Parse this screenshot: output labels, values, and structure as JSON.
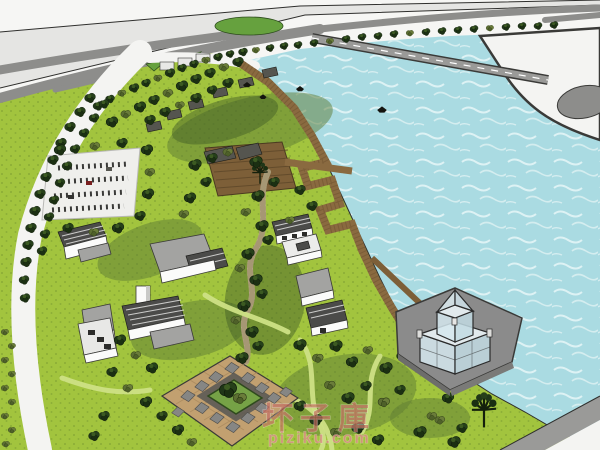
{
  "watermark": {
    "brand": "坏子庫",
    "domain": "piziku.com"
  },
  "palette": {
    "water": "#aadbe2",
    "water_wave": "#e9f7f8",
    "ground_white": "#f6f6f4",
    "highway_light": "#e5e5e3",
    "road_gray": "#8d8d8b",
    "lawn": "#a2c43e",
    "tree_dark": "#203618",
    "tree_olive": "#5c6e33",
    "boardwalk": "#8a6a40",
    "deck_wood": "#7d5f38",
    "building_wall": "#fbfbfa",
    "building_roof": "#a3a3a1",
    "roof_dark": "#4b4b49",
    "plaza_tan": "#c2a070",
    "plaza_gray": "#868684",
    "platform_gray": "#8b8b8b",
    "glass": "#d5e8ee",
    "watermark_red": "#b5483c",
    "watermark_pink": "#d98d86"
  },
  "scene": {
    "type": "3d-sketchup-aerial-site-plan",
    "elements": [
      "lake",
      "shoreline-boardwalk",
      "zigzag-pier",
      "wooden-deck",
      "glass-pavilion",
      "pavilion-platform",
      "causeway-bridge",
      "peninsula-roundabout",
      "highway-interchange",
      "tree-lined-avenue",
      "parking-lot",
      "village-cottages",
      "campus-buildings",
      "parterre-garden-plaza",
      "gravel-creek-path",
      "orchard-rows",
      "lawn-park",
      "boats",
      "grass-oval"
    ]
  }
}
